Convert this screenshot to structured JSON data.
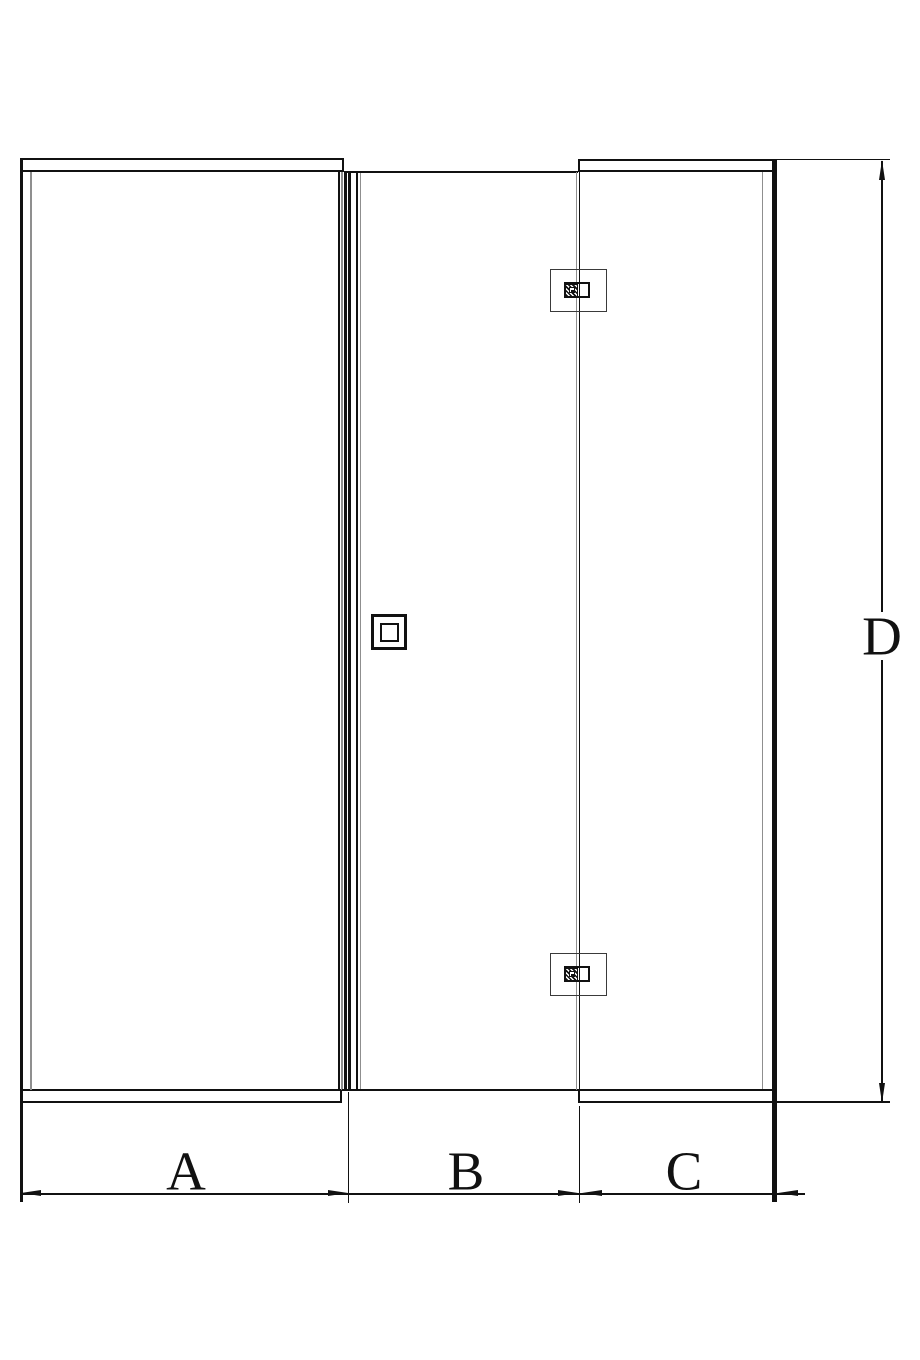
{
  "drawing": {
    "kind": "dimension-diagram",
    "view": "front-elevation-three-panel-glass-enclosure"
  },
  "dimensions": {
    "a": {
      "label": "A"
    },
    "b": {
      "label": "B"
    },
    "c": {
      "label": "C"
    },
    "d": {
      "label": "D"
    }
  },
  "components": {
    "hinge_top": "hinge-icon",
    "hinge_bottom": "hinge-icon",
    "knob": "door-knob-icon"
  },
  "colors": {
    "line": "#111111",
    "glass_edge": "#8f8f8f",
    "background": "#ffffff"
  }
}
